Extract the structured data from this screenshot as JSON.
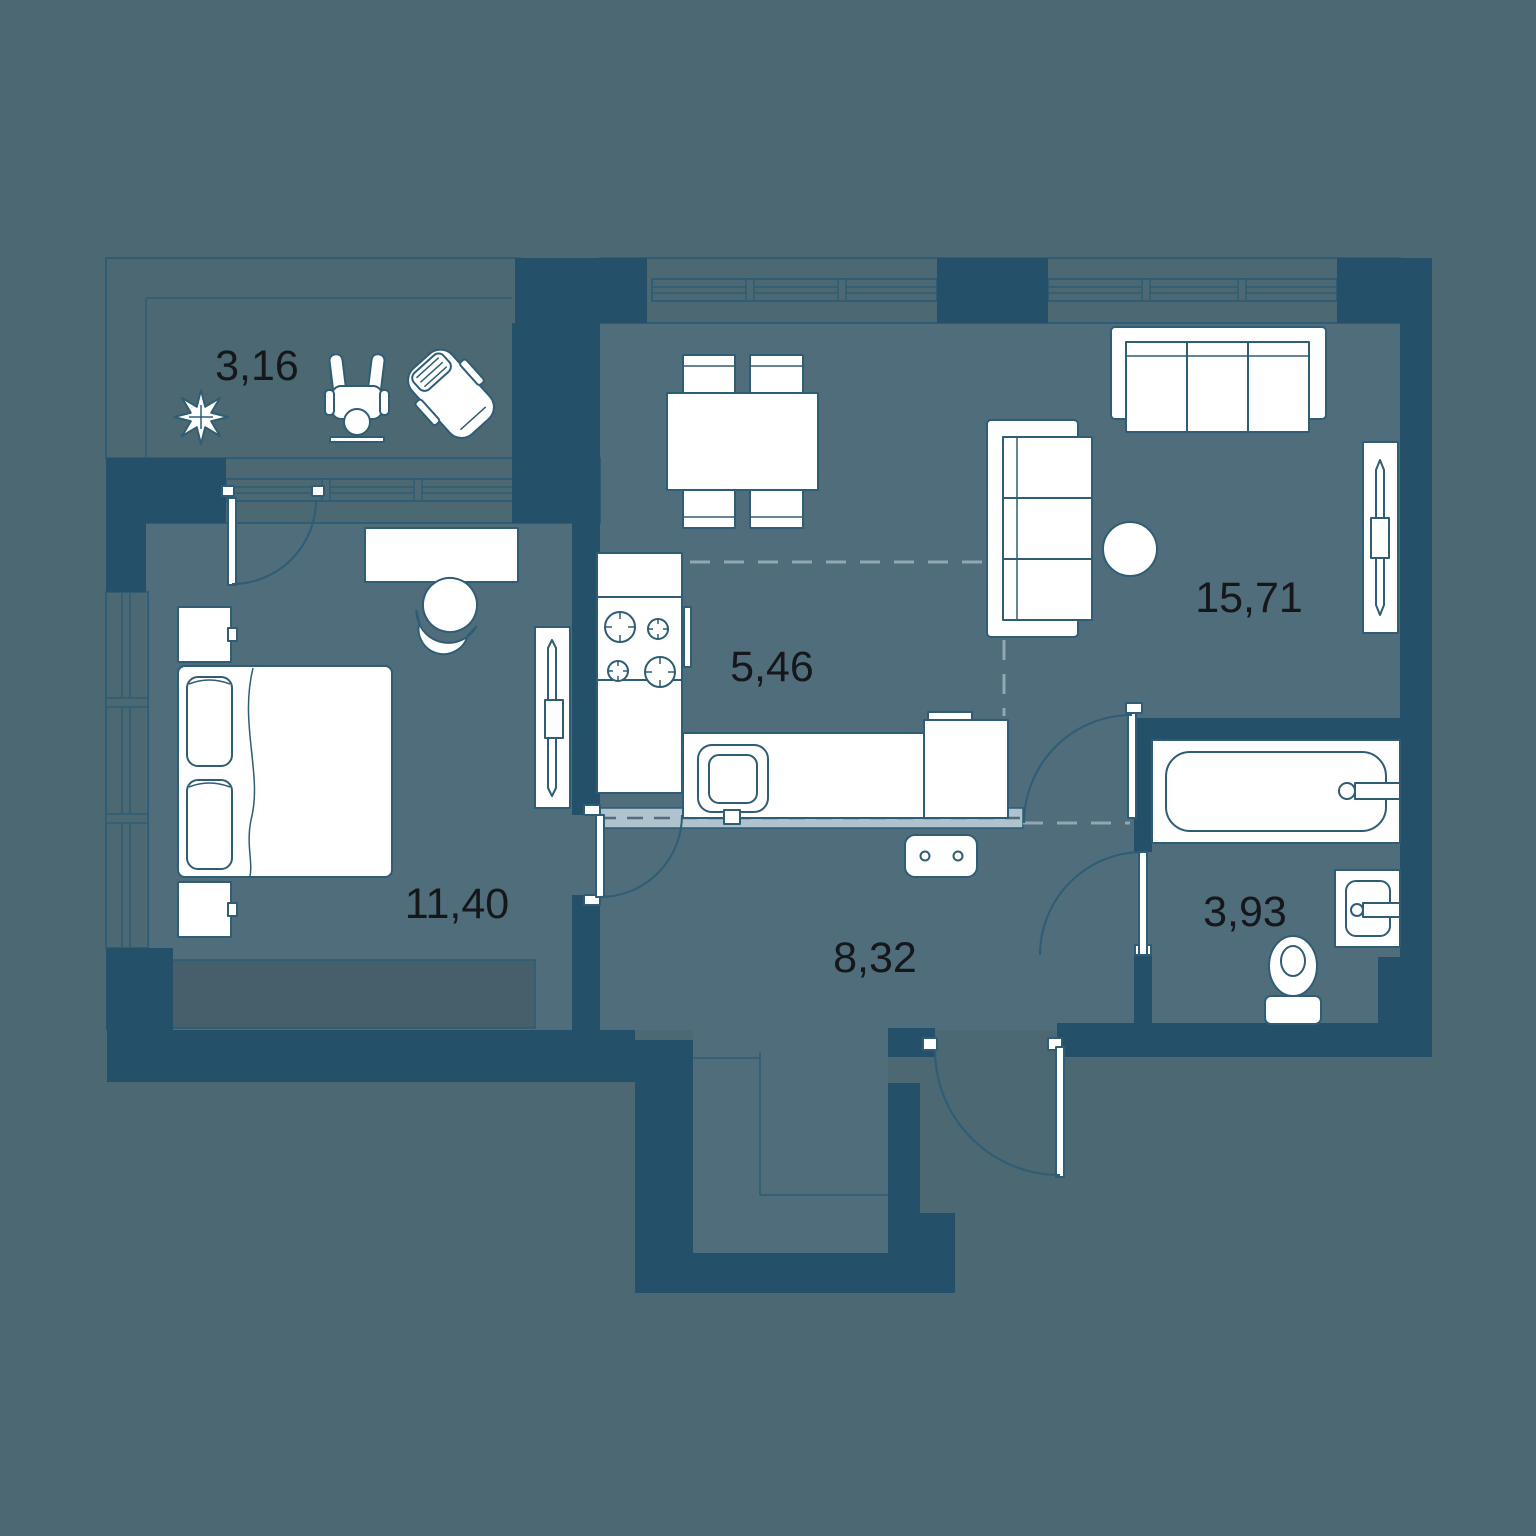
{
  "rooms": [
    {
      "id": "balcony",
      "area": "3,16"
    },
    {
      "id": "kitchen",
      "area": "5,46"
    },
    {
      "id": "living-room",
      "area": "15,71"
    },
    {
      "id": "bedroom",
      "area": "11,40"
    },
    {
      "id": "hallway",
      "area": "8,32"
    },
    {
      "id": "bathroom",
      "area": "3,93"
    }
  ],
  "colors": {
    "background": "#4B6873",
    "floor": "#4F6D7A",
    "walls": "#24506A",
    "outline": "#2E5D75",
    "fixtures": "#FFFFFF",
    "partition_band": "#AEC3CD",
    "label_text": "#16171B"
  }
}
